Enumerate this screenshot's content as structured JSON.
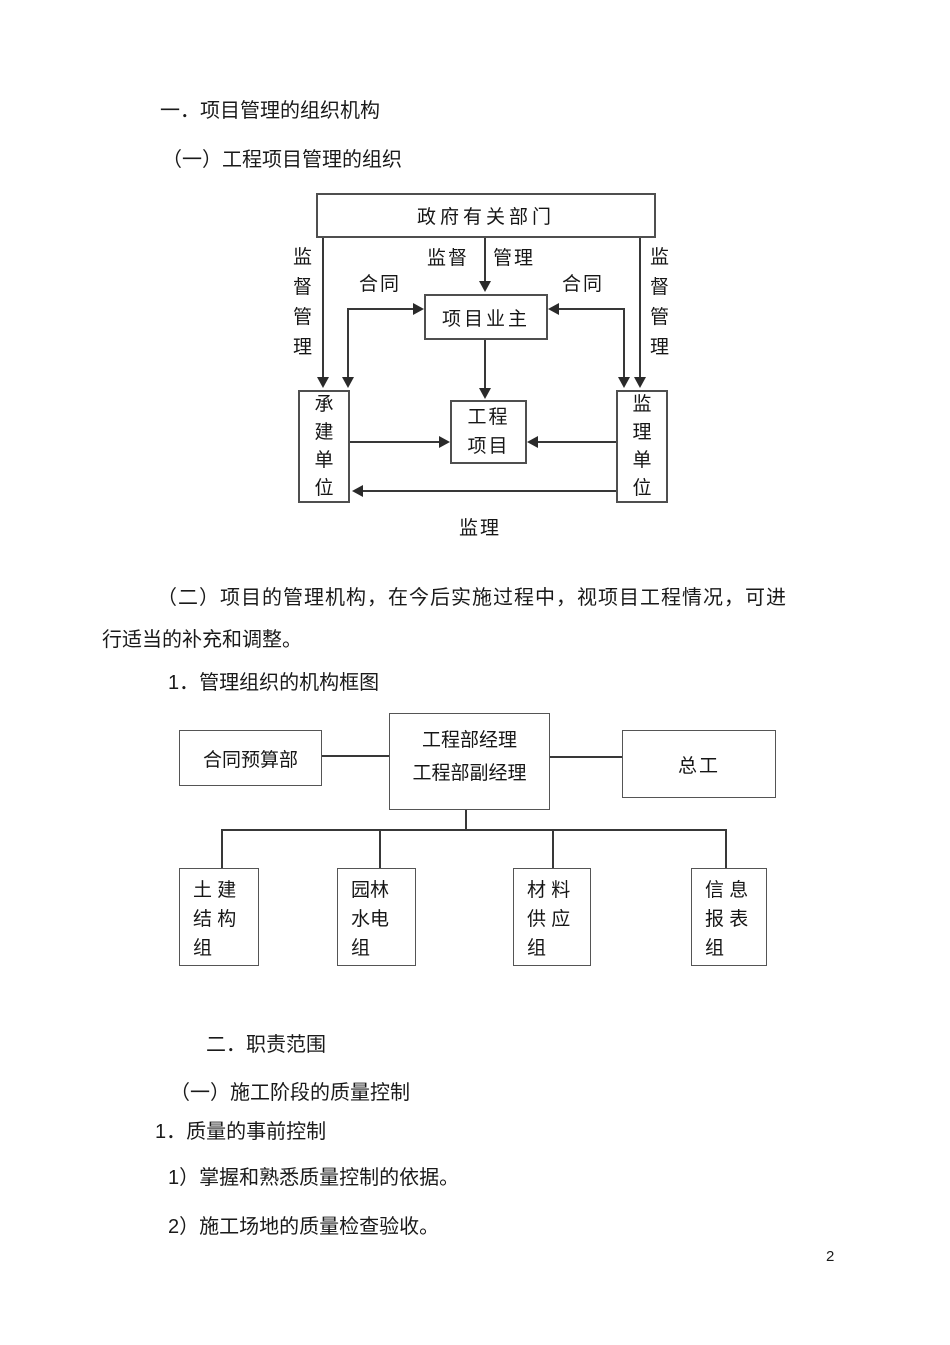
{
  "document": {
    "section1_title": "一．项目管理的组织机构",
    "section1_sub": "（一）工程项目管理的组织",
    "para_line1": "（二）项目的管理机构，在今后实施过程中，视项目工程情况，可进",
    "para_line2": "行适当的补充和调整。",
    "chart_heading": "1．管理组织的机构框图",
    "section2_title": "二．职责范围",
    "section2_sub": "（一）施工阶段的质量控制",
    "section2_item": "1．质量的事前控制",
    "list_item1": "1）掌握和熟悉质量控制的依据。",
    "list_item2": "2）施工场地的质量检查验收。",
    "page_number": "2"
  },
  "diagram1": {
    "gov": "政府有关部门",
    "owner": "项目业主",
    "project": "工程\n项目",
    "contractor": "承建单位",
    "supervisor": "监理单位",
    "label_left_vertical": "监督管理",
    "label_right_vertical": "监督管理",
    "label_supervise": "监督",
    "label_manage": "管理",
    "label_contract_left": "合同",
    "label_contract_right": "合同",
    "label_supervision_bottom": "监理"
  },
  "diagram2": {
    "manager": "工程部经理\n工程部副经理",
    "budget": "合同预算部",
    "chief": "总工",
    "group1": "土 建\n结 构\n组",
    "group2": "园林\n水电\n组",
    "group3": "材 料\n供 应\n组",
    "group4": "信 息\n报 表\n组"
  },
  "colors": {
    "text": "#1a1a1a",
    "line": "#383838",
    "border": "#4f4f4f",
    "background": "#ffffff"
  }
}
